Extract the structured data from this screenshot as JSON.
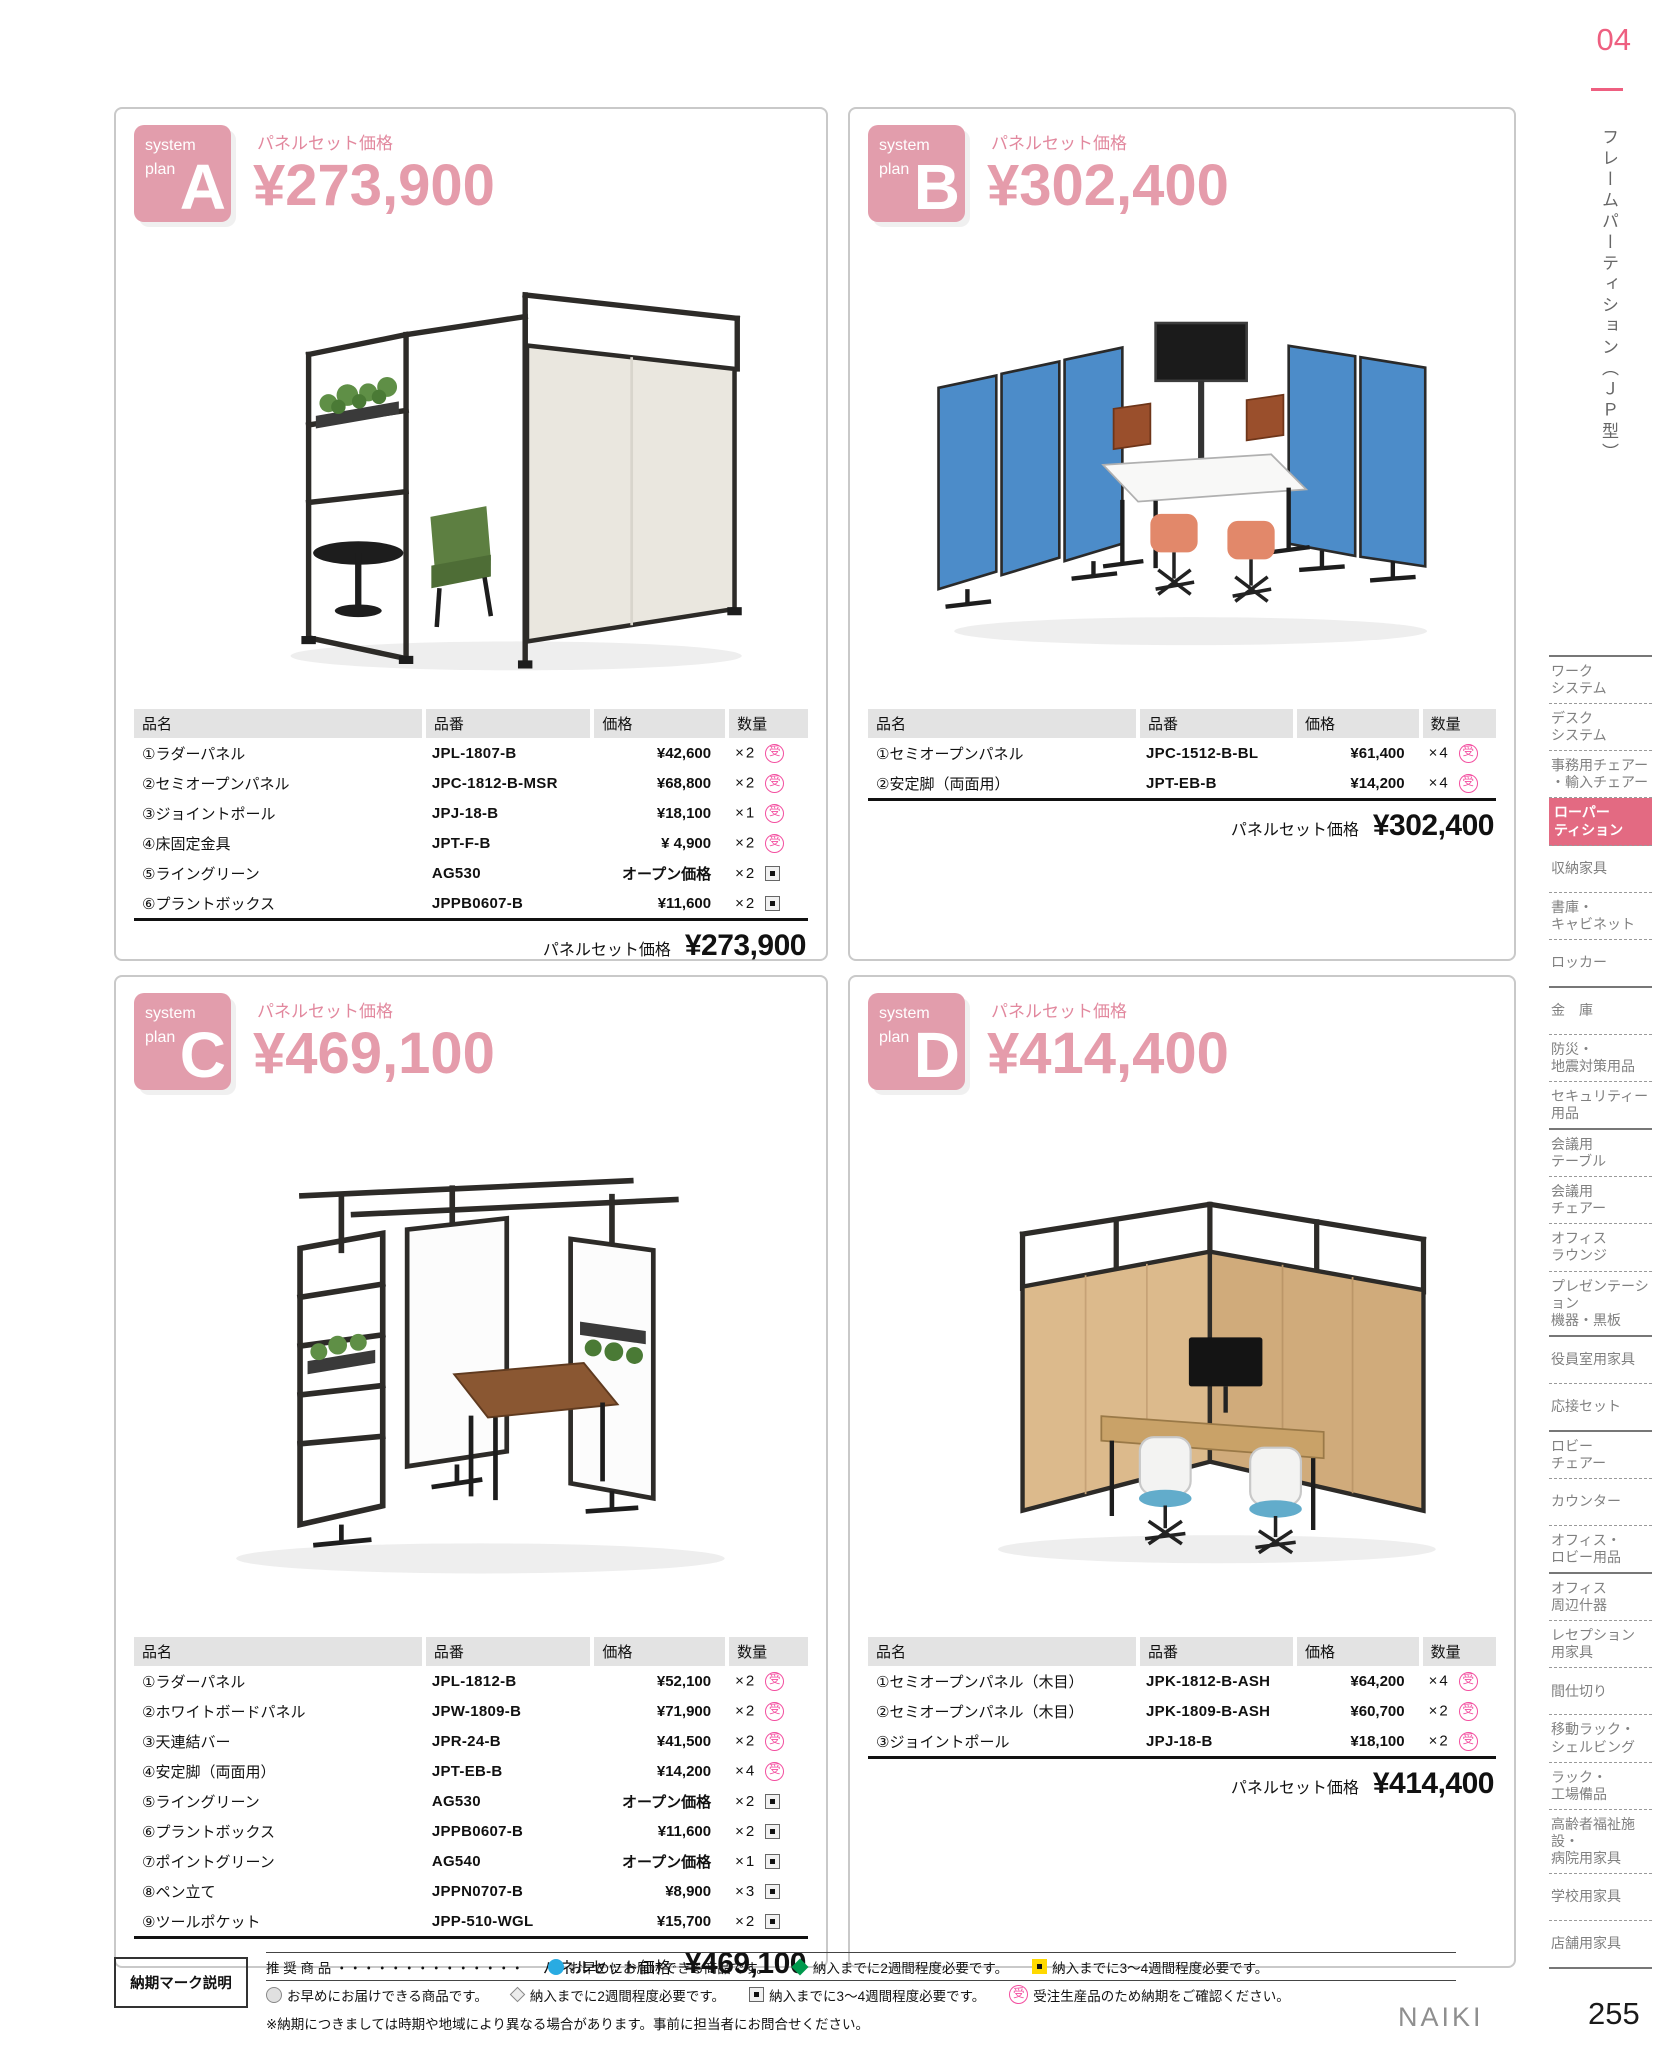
{
  "page": {
    "section_number": "04",
    "side_title": "フレームパーティション（ＪＰ型）",
    "brand": "NAIKI",
    "page_number": "255"
  },
  "table_headers": [
    "品名",
    "品番",
    "価格",
    "数量"
  ],
  "marks": {
    "jyu": "受",
    "sqdot": "",
    "blue-circle": "",
    "green-diamond": "",
    "yellow-sq": "",
    "gray-circle": "",
    "gray-diamond": ""
  },
  "plans": [
    {
      "badge_line1": "system",
      "badge_line2": "plan",
      "letter": "A",
      "price_label": "パネルセット価格",
      "price": "¥273,900",
      "table": {
        "rows": [
          {
            "name": "①ラダーパネル",
            "code": "JPL-1807-B",
            "price": "¥42,600",
            "qty": "×2",
            "mark": "jyu"
          },
          {
            "name": "②セミオープンパネル",
            "code": "JPC-1812-B-MSR",
            "price": "¥68,800",
            "qty": "×2",
            "mark": "jyu"
          },
          {
            "name": "③ジョイントポール",
            "code": "JPJ-18-B",
            "price": "¥18,100",
            "qty": "×1",
            "mark": "jyu"
          },
          {
            "name": "④床固定金具",
            "code": "JPT-F-B",
            "price": "¥ 4,900",
            "qty": "×2",
            "mark": "jyu"
          },
          {
            "name": "⑤ライングリーン",
            "code": "AG530",
            "price": "オープン価格",
            "qty": "×2",
            "mark": "sqdot"
          },
          {
            "name": "⑥プラントボックス",
            "code": "JPPB0607-B",
            "price": "¥11,600",
            "qty": "×2",
            "mark": "sqdot"
          }
        ],
        "total_label": "パネルセット価格",
        "total": "¥273,900"
      }
    },
    {
      "badge_line1": "system",
      "badge_line2": "plan",
      "letter": "B",
      "price_label": "パネルセット価格",
      "price": "¥302,400",
      "table": {
        "rows": [
          {
            "name": "①セミオープンパネル",
            "code": "JPC-1512-B-BL",
            "price": "¥61,400",
            "qty": "×4",
            "mark": "jyu"
          },
          {
            "name": "②安定脚（両面用）",
            "code": "JPT-EB-B",
            "price": "¥14,200",
            "qty": "×4",
            "mark": "jyu"
          }
        ],
        "total_label": "パネルセット価格",
        "total": "¥302,400"
      }
    },
    {
      "badge_line1": "system",
      "badge_line2": "plan",
      "letter": "C",
      "price_label": "パネルセット価格",
      "price": "¥469,100",
      "table": {
        "rows": [
          {
            "name": "①ラダーパネル",
            "code": "JPL-1812-B",
            "price": "¥52,100",
            "qty": "×2",
            "mark": "jyu"
          },
          {
            "name": "②ホワイトボードパネル",
            "code": "JPW-1809-B",
            "price": "¥71,900",
            "qty": "×2",
            "mark": "jyu"
          },
          {
            "name": "③天連結バー",
            "code": "JPR-24-B",
            "price": "¥41,500",
            "qty": "×2",
            "mark": "jyu"
          },
          {
            "name": "④安定脚（両面用）",
            "code": "JPT-EB-B",
            "price": "¥14,200",
            "qty": "×4",
            "mark": "jyu"
          },
          {
            "name": "⑤ライングリーン",
            "code": "AG530",
            "price": "オープン価格",
            "qty": "×2",
            "mark": "sqdot"
          },
          {
            "name": "⑥プラントボックス",
            "code": "JPPB0607-B",
            "price": "¥11,600",
            "qty": "×2",
            "mark": "sqdot"
          },
          {
            "name": "⑦ポイントグリーン",
            "code": "AG540",
            "price": "オープン価格",
            "qty": "×1",
            "mark": "sqdot"
          },
          {
            "name": "⑧ペン立て",
            "code": "JPPN0707-B",
            "price": "¥8,900",
            "qty": "×3",
            "mark": "sqdot"
          },
          {
            "name": "⑨ツールポケット",
            "code": "JPP-510-WGL",
            "price": "¥15,700",
            "qty": "×2",
            "mark": "sqdot"
          }
        ],
        "total_label": "パネルセット価格",
        "total": "¥469,100"
      }
    },
    {
      "badge_line1": "system",
      "badge_line2": "plan",
      "letter": "D",
      "price_label": "パネルセット価格",
      "price": "¥414,400",
      "table": {
        "rows": [
          {
            "name": "①セミオープンパネル（木目）",
            "code": "JPK-1812-B-ASH",
            "price": "¥64,200",
            "qty": "×4",
            "mark": "jyu"
          },
          {
            "name": "②セミオープンパネル（木目）",
            "code": "JPK-1809-B-ASH",
            "price": "¥60,700",
            "qty": "×2",
            "mark": "jyu"
          },
          {
            "name": "③ジョイントポール",
            "code": "JPJ-18-B",
            "price": "¥18,100",
            "qty": "×2",
            "mark": "jyu"
          }
        ],
        "total_label": "パネルセット価格",
        "total": "¥414,400"
      }
    }
  ],
  "sidebar": {
    "items": [
      {
        "label": "ワーク\nシステム",
        "divider": "dotted"
      },
      {
        "label": "デスク\nシステム",
        "divider": "dotted"
      },
      {
        "label": "事務用チェアー\n・輸入チェアー",
        "divider": "dotted"
      },
      {
        "label": "ローパー\nティション",
        "divider": "dotted",
        "active": true
      },
      {
        "label": "収納家具",
        "divider": "dotted"
      },
      {
        "label": "書庫・\nキャビネット",
        "divider": "dotted"
      },
      {
        "label": "ロッカー",
        "divider": "solid"
      },
      {
        "label": "金　庫",
        "divider": "dotted"
      },
      {
        "label": "防災・\n地震対策用品",
        "divider": "dotted"
      },
      {
        "label": "セキュリティー\n用品",
        "divider": "solid"
      },
      {
        "label": "会議用\nテーブル",
        "divider": "dotted"
      },
      {
        "label": "会議用\nチェアー",
        "divider": "dotted"
      },
      {
        "label": "オフィス\nラウンジ",
        "divider": "dotted"
      },
      {
        "label": "プレゼンテーション\n機器・黒板",
        "divider": "solid"
      },
      {
        "label": "役員室用家具",
        "divider": "dotted"
      },
      {
        "label": "応接セット",
        "divider": "solid"
      },
      {
        "label": "ロビー\nチェアー",
        "divider": "dotted"
      },
      {
        "label": "カウンター",
        "divider": "dotted"
      },
      {
        "label": "オフィス・\nロビー用品",
        "divider": "solid"
      },
      {
        "label": "オフィス\n周辺什器",
        "divider": "dotted"
      },
      {
        "label": "レセプション\n用家具",
        "divider": "dotted"
      },
      {
        "label": "間仕切り",
        "divider": "dotted"
      },
      {
        "label": "移動ラック・\nシェルビング",
        "divider": "dotted"
      },
      {
        "label": "ラック・\n工場備品",
        "divider": "dotted"
      },
      {
        "label": "高齢者福祉施設・\n病院用家具",
        "divider": "dotted"
      },
      {
        "label": "学校用家具",
        "divider": "dotted"
      },
      {
        "label": "店舗用家具",
        "divider": "solid"
      }
    ]
  },
  "legend": {
    "box_label": "納期マーク説明",
    "row1": [
      {
        "text": "推 奨 商 品  ・・・・・・・・・・・・・・"
      },
      {
        "mark": "blue-circle",
        "text": "お早めにお届けできる商品です。"
      },
      {
        "mark": "green-diamond",
        "text": "納入までに2週間程度必要です。"
      },
      {
        "mark": "yellow-sq",
        "text": "納入までに3～4週間程度必要です。"
      }
    ],
    "row2": [
      {
        "mark": "gray-circle",
        "text": "お早めにお届けできる商品です。"
      },
      {
        "mark": "gray-diamond",
        "text": "納入までに2週間程度必要です。"
      },
      {
        "mark": "sqdot",
        "text": "納入までに3～4週間程度必要です。"
      },
      {
        "mark": "jyu",
        "text": "受注生産品のため納期をご確認ください。"
      }
    ],
    "row3": "※納期につきましては時期や地域により異なる場合があります。事前に担当者にお問合せください。"
  }
}
